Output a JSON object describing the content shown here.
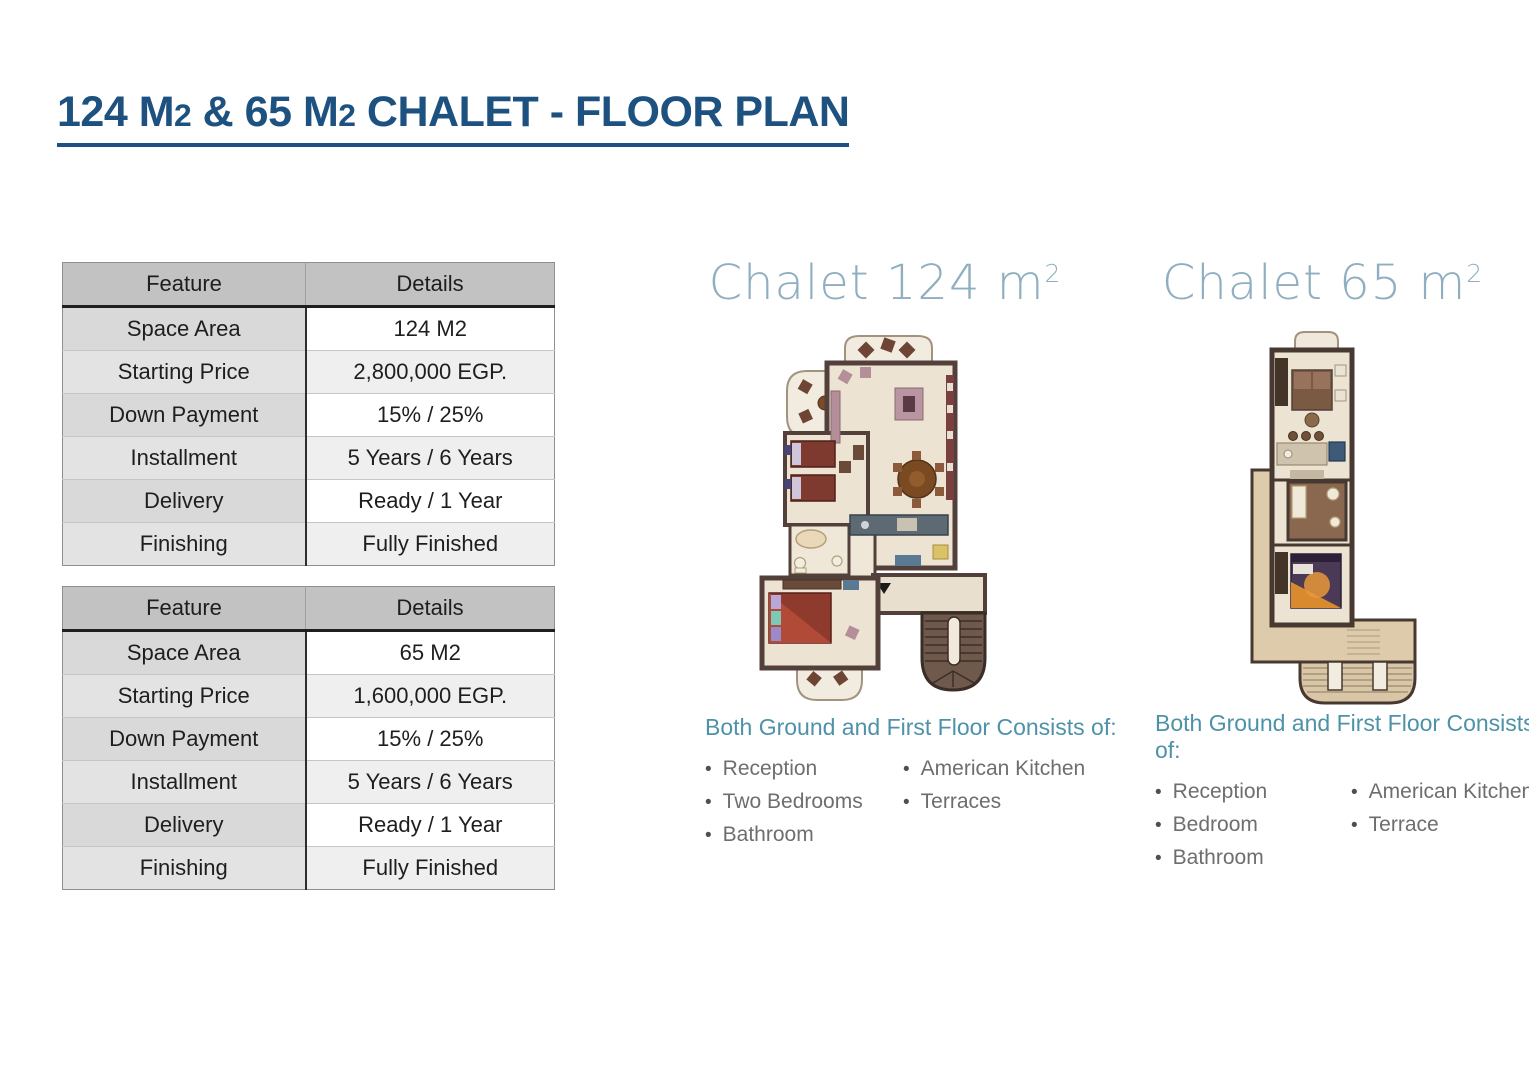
{
  "title": {
    "parts": [
      "124 M",
      "2",
      " & 65 M",
      "2",
      " CHALET - FLOOR PLAN"
    ]
  },
  "icons": {
    "bullet": "•"
  },
  "colors": {
    "title_blue": "#1d5180",
    "chalet_heading_blue": "#8fafc1",
    "consists_teal": "#4d92a8",
    "bullet_text_grey": "#6e6e6e",
    "table_header_grey": "#c2c2c2"
  },
  "tables": [
    {
      "headers": [
        "Feature",
        "Details"
      ],
      "rows": [
        [
          "Space Area",
          "124 M2"
        ],
        [
          "Starting Price",
          "2,800,000 EGP."
        ],
        [
          "Down Payment",
          "15% / 25%"
        ],
        [
          "Installment",
          "5 Years / 6 Years"
        ],
        [
          "Delivery",
          "Ready / 1 Year"
        ],
        [
          "Finishing",
          "Fully Finished"
        ]
      ]
    },
    {
      "headers": [
        "Feature",
        "Details"
      ],
      "rows": [
        [
          "Space Area",
          "65 M2"
        ],
        [
          "Starting Price",
          "1,600,000 EGP."
        ],
        [
          "Down Payment",
          "15% / 25%"
        ],
        [
          "Installment",
          "5 Years / 6 Years"
        ],
        [
          "Delivery",
          "Ready / 1 Year"
        ],
        [
          "Finishing",
          "Fully Finished"
        ]
      ]
    }
  ],
  "plans": [
    {
      "heading": "Chalet 124 m",
      "heading_sup": "2",
      "consists_title": "Both Ground and First Floor Consists of:",
      "bullets_left": [
        "Reception",
        "Two Bedrooms",
        "Bathroom"
      ],
      "bullets_right": [
        "American Kitchen",
        "Terraces"
      ]
    },
    {
      "heading": "Chalet 65 m",
      "heading_sup": "2",
      "consists_title": "Both Ground and First Floor Consists of:",
      "bullets_left": [
        "Reception",
        "Bedroom",
        "Bathroom"
      ],
      "bullets_right": [
        "American Kitchen",
        "Terrace"
      ]
    }
  ]
}
